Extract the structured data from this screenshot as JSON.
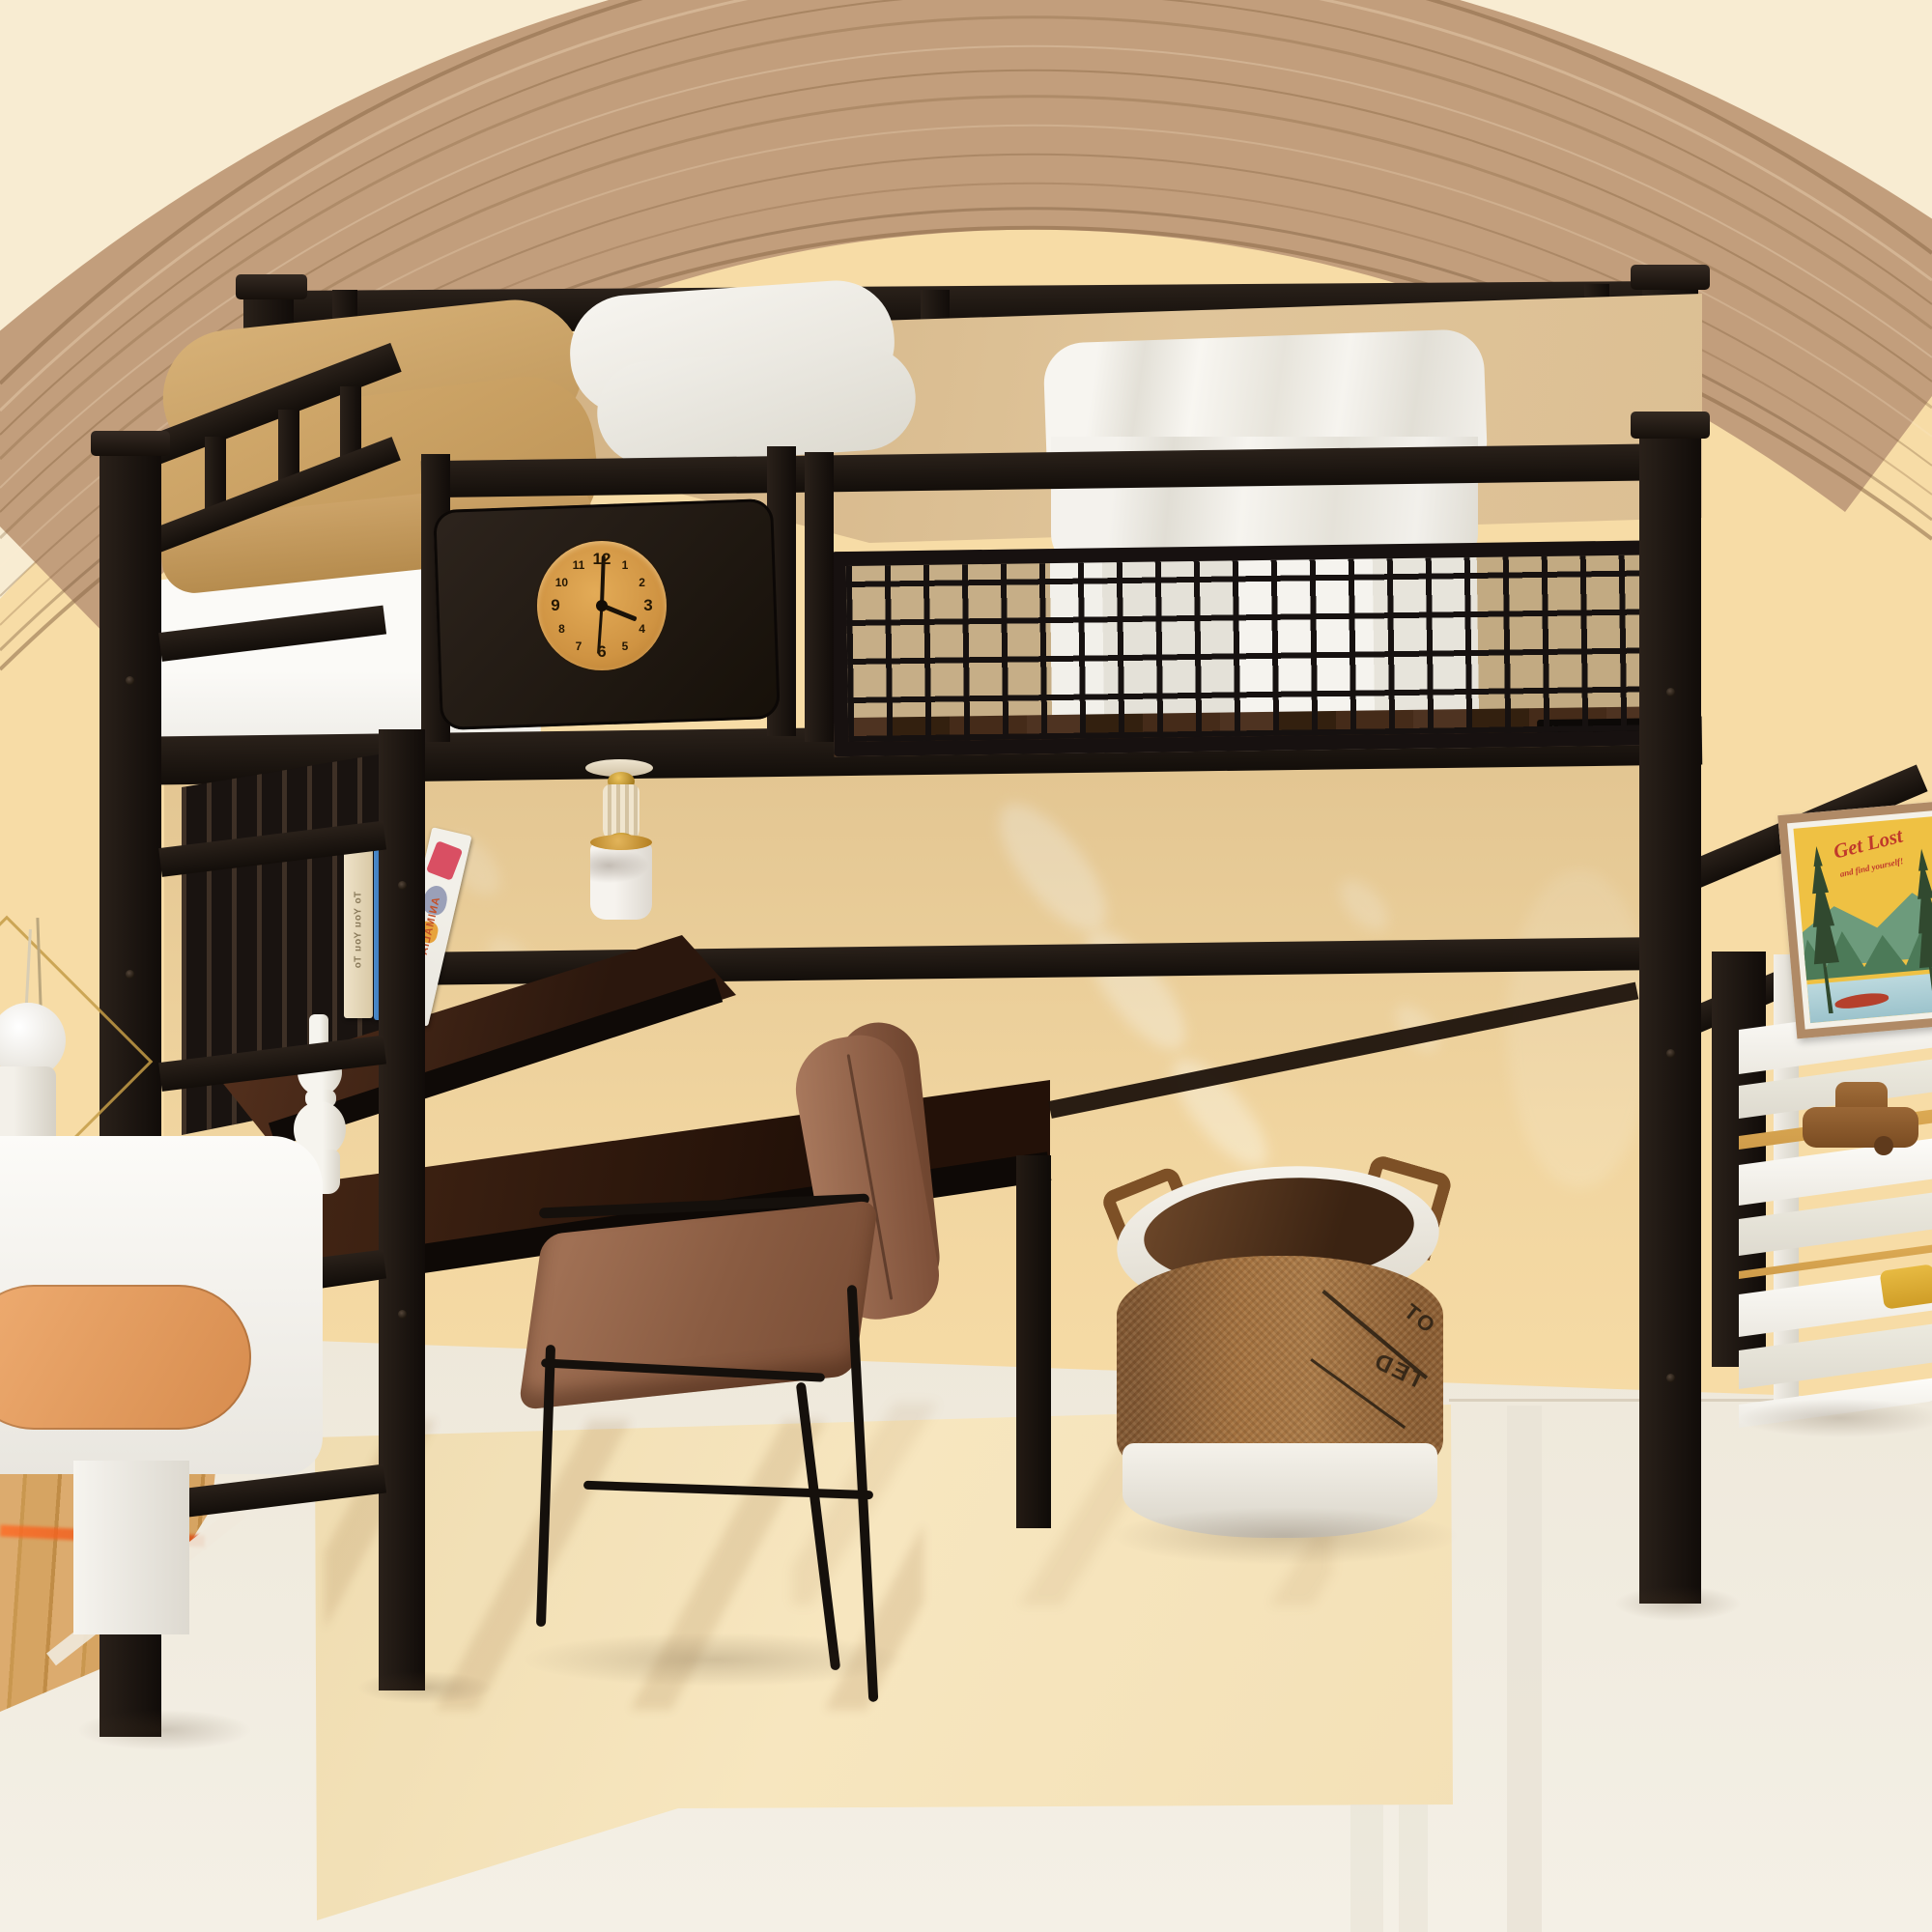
{
  "scene": {
    "name": "Black metal loft bed with desk and ladder in a child bedroom",
    "style": "photorealistic 3D furniture render",
    "objects": [
      "loft bed",
      "mesh guardrail",
      "wall clock panel",
      "pendant lamp",
      "desk with bookshelf",
      "pegboard",
      "ladder",
      "leather chair",
      "laundry basket",
      "nightstand with lamp",
      "tiered white shelf",
      "framed poster",
      "wooden toy car",
      "arched wood wall trim"
    ]
  },
  "palette": {
    "wall_outer": "#f8ecd2",
    "wall_arch_inner": "#f7dca6",
    "arch_wood": "#c29e7c",
    "metal_black": "#1a1410",
    "mattress_tan": "#d6b98c",
    "bedding_white": "#f5f3ee",
    "desk_walnut": "#3a2114",
    "floor_ivory": "#f2ecdf",
    "rug_beige": "#f6e3ba",
    "wood_floor": "#d7a669",
    "chair_leather": "#96684e",
    "basket_burlap": "#9a6a40",
    "canvas_white": "#f2efe8",
    "accent_orange": "#e8a36c",
    "clock_face": "#d9a14c",
    "poster_sky": "#efc143",
    "poster_red": "#c0392b"
  },
  "clock": {
    "numbers": [
      "12",
      "1",
      "2",
      "3",
      "4",
      "5",
      "6",
      "7",
      "8",
      "9",
      "10",
      "11"
    ],
    "time_label": "4:00"
  },
  "books": [
    {
      "title": "To You You To",
      "note": "cream spine, title mirrored"
    },
    {
      "title": "The book of UNSEEN WORLD",
      "note": "blue spine, title mirrored"
    },
    {
      "title": "ANIMALIA",
      "note": "white picture book, leaning, mirrored"
    }
  ],
  "poster": {
    "title": "Get Lost",
    "subtitle": "and find yourself!"
  },
  "basket": {
    "stamp_line1": "OT",
    "stamp_line2": "TED",
    "note": "partial mirrored stamp print on burlap"
  }
}
